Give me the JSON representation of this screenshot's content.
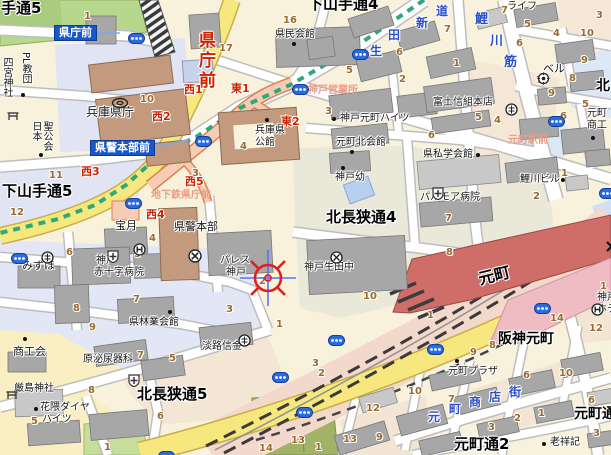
{
  "map": {
    "colors": {
      "road_yellow": "#f6e87f",
      "rail_band_pink": "#f3d9cb",
      "jr_station_red": "#cf6d68",
      "hanshin_station_pink": "#f0bcc4",
      "subway_line_green": "#2fa87c",
      "subway_corridor_salmon": "#f6cdb4",
      "station_badge_blue": "#1658cc",
      "exit_label_red": "#cc2200",
      "block_number_brown": "#9a6a2f",
      "street_name_blue": "#2b50c8",
      "area_label_pink": "#eb9c87"
    },
    "labels": [
      {
        "t": "手通5",
        "x": 1,
        "y": 1,
        "c": "d",
        "fs": 15,
        "n": "district-label"
      },
      {
        "t": "下山手通4",
        "x": 308,
        "y": -3,
        "c": "d",
        "fs": 15,
        "n": "district-label"
      },
      {
        "t": "下山手通5",
        "x": 2,
        "y": 184,
        "c": "d",
        "fs": 15,
        "n": "district-label"
      },
      {
        "t": "北長狭通4",
        "x": 326,
        "y": 210,
        "c": "d",
        "fs": 15,
        "n": "district-label"
      },
      {
        "t": "北長狭通5",
        "x": 137,
        "y": 387,
        "c": "d",
        "fs": 15,
        "n": "district-label"
      },
      {
        "t": "元町通2",
        "x": 454,
        "y": 437,
        "c": "d",
        "fs": 15,
        "n": "district-label"
      },
      {
        "t": "元町通",
        "x": 574,
        "y": 407,
        "c": "d",
        "fs": 14,
        "n": "district-label"
      },
      {
        "t": "北",
        "x": 596,
        "y": 79,
        "c": "d",
        "fs": 14,
        "n": "district-label"
      },
      {
        "t": "阪神元町",
        "x": 498,
        "y": 332,
        "c": "d",
        "fs": 14,
        "n": "hanshin-motomachi-station-label"
      },
      {
        "t": "元町",
        "x": 477,
        "y": 272,
        "c": "d",
        "fs": 16,
        "r": -14,
        "n": "jr-motomachi-station-label"
      },
      {
        "t": "県庁前",
        "x": 196,
        "y": 31,
        "c": "rv",
        "n": "subway-kenchomae-label"
      },
      {
        "t": "西1",
        "x": 184,
        "y": 84,
        "c": "r",
        "n": "exit-label"
      },
      {
        "t": "東1",
        "x": 231,
        "y": 83,
        "c": "r",
        "n": "exit-label"
      },
      {
        "t": "西2",
        "x": 152,
        "y": 111,
        "c": "r",
        "n": "exit-label"
      },
      {
        "t": "東2",
        "x": 281,
        "y": 116,
        "c": "r",
        "n": "exit-label"
      },
      {
        "t": "西3",
        "x": 81,
        "y": 166,
        "c": "r",
        "n": "exit-label"
      },
      {
        "t": "西5",
        "x": 185,
        "y": 176,
        "c": "r",
        "n": "exit-label"
      },
      {
        "t": "西4",
        "x": 146,
        "y": 209,
        "c": "r",
        "n": "exit-label"
      },
      {
        "t": "神戸営業所",
        "x": 308,
        "y": 86,
        "c": "pk",
        "n": "area-label"
      },
      {
        "t": "地下鉄県庁前",
        "x": 151,
        "y": 191,
        "c": "pk",
        "n": "area-label"
      },
      {
        "t": "元町駅前",
        "x": 508,
        "y": 136,
        "c": "pk",
        "n": "area-label"
      },
      {
        "t": "生",
        "x": 370,
        "y": 45,
        "c": "b",
        "n": "street-name-ikuta-shindo"
      },
      {
        "t": "田",
        "x": 388,
        "y": 29,
        "c": "b",
        "n": "street-name-ikuta-shindo"
      },
      {
        "t": "新",
        "x": 416,
        "y": 17,
        "c": "b",
        "n": "street-name-ikuta-shindo"
      },
      {
        "t": "道",
        "x": 436,
        "y": 5,
        "c": "b",
        "n": "street-name-ikuta-shindo"
      },
      {
        "t": "鯉",
        "x": 475,
        "y": 13,
        "c": "b",
        "fs": 13,
        "n": "street-name-koikawa-suji"
      },
      {
        "t": "川",
        "x": 490,
        "y": 35,
        "c": "b",
        "fs": 13,
        "n": "street-name-koikawa-suji"
      },
      {
        "t": "筋",
        "x": 504,
        "y": 56,
        "c": "b",
        "fs": 13,
        "n": "street-name-koikawa-suji"
      },
      {
        "t": "元",
        "x": 428,
        "y": 411,
        "c": "b",
        "n": "street-name-motomachi-shotengai"
      },
      {
        "t": "町",
        "x": 449,
        "y": 403,
        "c": "b",
        "n": "street-name-motomachi-shotengai"
      },
      {
        "t": "商",
        "x": 469,
        "y": 396,
        "c": "b",
        "n": "street-name-motomachi-shotengai"
      },
      {
        "t": "店",
        "x": 489,
        "y": 391,
        "c": "b",
        "n": "street-name-motomachi-shotengai"
      },
      {
        "t": "街",
        "x": 509,
        "y": 386,
        "c": "b",
        "n": "street-name-motomachi-shotengai"
      },
      {
        "t": "県庁前",
        "x": 54,
        "y": 25,
        "c": "bd",
        "n": "station-badge-kenchomae"
      },
      {
        "t": "県警本部前",
        "x": 90,
        "y": 140,
        "c": "bd",
        "n": "station-badge-kenkeihonbumae"
      },
      {
        "t": "兵庫県庁",
        "x": 86,
        "y": 106,
        "c": "p",
        "fs": 12,
        "n": "poi-hyogo-prefectural-office"
      },
      {
        "t": "県民会館",
        "x": 275,
        "y": 30,
        "c": "p",
        "n": "poi-kenmin-kaikan"
      },
      {
        "t": "兵庫県",
        "x": 255,
        "y": 126,
        "c": "p",
        "n": "poi-hyogo-kokan"
      },
      {
        "t": "公館",
        "x": 255,
        "y": 138,
        "c": "p",
        "n": "poi-hyogo-kokan"
      },
      {
        "t": "県警本部",
        "x": 174,
        "y": 221,
        "c": "p",
        "fs": 11,
        "n": "poi-police-hq"
      },
      {
        "t": "パレス",
        "x": 220,
        "y": 256,
        "c": "p",
        "n": "poi-palace-kobe"
      },
      {
        "t": "神戸",
        "x": 226,
        "y": 268,
        "c": "p",
        "n": "poi-palace-kobe"
      },
      {
        "t": "宝月",
        "x": 115,
        "y": 220,
        "c": "p",
        "fs": 11,
        "n": "poi-hogetsu"
      },
      {
        "t": "みずほ",
        "x": 22,
        "y": 260,
        "c": "p",
        "fs": 11,
        "n": "poi-mizuho"
      },
      {
        "t": "神戸",
        "x": 96,
        "y": 256,
        "c": "p",
        "n": "poi-red-cross-hospital"
      },
      {
        "t": "赤十字病院",
        "x": 94,
        "y": 268,
        "c": "p",
        "n": "poi-red-cross-hospital"
      },
      {
        "t": "県林業会館",
        "x": 129,
        "y": 318,
        "c": "p",
        "n": "poi-kenringyo-kaikan"
      },
      {
        "t": "商工会",
        "x": 13,
        "y": 346,
        "c": "p",
        "fs": 11,
        "n": "poi-shokokai"
      },
      {
        "t": "厳島神社",
        "x": 14,
        "y": 384,
        "c": "p",
        "n": "poi-itsukushima-shrine"
      },
      {
        "t": "花隈ダイヤ",
        "x": 40,
        "y": 403,
        "c": "p",
        "n": "poi-hanakuma-daiya-heights"
      },
      {
        "t": "ハイツ",
        "x": 42,
        "y": 415,
        "c": "p",
        "n": "poi-hanakuma-daiya-heights"
      },
      {
        "t": "原泌尿器科",
        "x": 83,
        "y": 355,
        "c": "p",
        "n": "poi-hara-urology"
      },
      {
        "t": "淡路信金",
        "x": 202,
        "y": 342,
        "c": "p",
        "n": "poi-awaji-shinkin"
      },
      {
        "t": "神戸元町ハイツ",
        "x": 340,
        "y": 114,
        "c": "p",
        "n": "poi-kobe-motomachi-heights"
      },
      {
        "t": "元町北会館",
        "x": 336,
        "y": 138,
        "c": "p",
        "n": "poi-motomachi-kita-kaikan"
      },
      {
        "t": "神戸幼",
        "x": 335,
        "y": 173,
        "c": "p",
        "n": "poi-kobe-kindergarten"
      },
      {
        "t": "県私学会館",
        "x": 423,
        "y": 150,
        "c": "p",
        "n": "poi-shigaku-kaikan"
      },
      {
        "t": "パルモア病院",
        "x": 420,
        "y": 193,
        "c": "p",
        "n": "poi-palmore-hospital"
      },
      {
        "t": "富士信組本店",
        "x": 433,
        "y": 98,
        "c": "p",
        "n": "poi-fuji-shinkumi"
      },
      {
        "t": "鯉川ビル",
        "x": 520,
        "y": 175,
        "c": "p",
        "n": "poi-koikawa-building"
      },
      {
        "t": "ベル",
        "x": 543,
        "y": 63,
        "c": "p",
        "fs": 11,
        "n": "poi-bell"
      },
      {
        "t": "元町",
        "x": 511,
        "y": -9,
        "c": "p",
        "n": "poi-motomachi-life"
      },
      {
        "t": "ライフ",
        "x": 507,
        "y": 2,
        "c": "p",
        "n": "poi-motomachi-life"
      },
      {
        "t": "神戸生田中",
        "x": 304,
        "y": 263,
        "c": "p",
        "n": "poi-kobe-ikuta-junior-high"
      },
      {
        "t": "元町プラザ",
        "x": 448,
        "y": 367,
        "c": "p",
        "n": "poi-motomachi-plaza"
      },
      {
        "t": "老祥記",
        "x": 550,
        "y": 438,
        "c": "p",
        "n": "poi-roshoki"
      },
      {
        "t": "元町",
        "x": 587,
        "y": 109,
        "c": "p",
        "n": "poi-motomachi-shoko"
      },
      {
        "t": "商工",
        "x": 587,
        "y": 121,
        "c": "p",
        "n": "poi-motomachi-shoko"
      },
      {
        "t": "神戸",
        "x": 597,
        "y": 293,
        "c": "p",
        "n": "poi-kobe-hotel"
      },
      {
        "t": "ホテ",
        "x": 597,
        "y": 305,
        "c": "p",
        "n": "poi-kobe-hotel"
      },
      {
        "t": "四宮神社",
        "x": 1,
        "y": 57,
        "c": "p",
        "v": 1,
        "n": "poi-shinomiya-shrine"
      },
      {
        "t": "PL教団",
        "x": 20,
        "y": 52,
        "c": "p",
        "v": 1,
        "n": "poi-pl-kyodan"
      },
      {
        "t": "日本",
        "x": 30,
        "y": 121,
        "c": "p",
        "v": 1,
        "n": "poi-nihon-seikokai"
      },
      {
        "t": "聖公会",
        "x": 41,
        "y": 121,
        "c": "p",
        "v": 1,
        "n": "poi-nihon-seikokai"
      },
      {
        "t": "1",
        "x": 84,
        "y": 12,
        "c": "n"
      },
      {
        "t": "17",
        "x": 219,
        "y": 44,
        "c": "n"
      },
      {
        "t": "16",
        "x": 283,
        "y": 16,
        "c": "n"
      },
      {
        "t": "10",
        "x": 140,
        "y": 95,
        "c": "n"
      },
      {
        "t": "4",
        "x": 240,
        "y": 142,
        "c": "n"
      },
      {
        "t": "3",
        "x": 192,
        "y": 169,
        "c": "n"
      },
      {
        "t": "11",
        "x": 49,
        "y": 171,
        "c": "n"
      },
      {
        "t": "12",
        "x": 10,
        "y": 208,
        "c": "n"
      },
      {
        "t": "7",
        "x": 501,
        "y": 6,
        "c": "n"
      },
      {
        "t": "5",
        "x": 524,
        "y": 20,
        "c": "n"
      },
      {
        "t": "4",
        "x": 553,
        "y": 29,
        "c": "n"
      },
      {
        "t": "10",
        "x": 580,
        "y": 29,
        "c": "n"
      },
      {
        "t": "3",
        "x": 596,
        "y": 11,
        "c": "n"
      },
      {
        "t": "7",
        "x": 444,
        "y": 25,
        "c": "n"
      },
      {
        "t": "6",
        "x": 396,
        "y": 48,
        "c": "n"
      },
      {
        "t": "1",
        "x": 453,
        "y": 59,
        "c": "n"
      },
      {
        "t": "2",
        "x": 399,
        "y": 75,
        "c": "n"
      },
      {
        "t": "5",
        "x": 346,
        "y": 66,
        "c": "n"
      },
      {
        "t": "3",
        "x": 325,
        "y": 107,
        "c": "n"
      },
      {
        "t": "6",
        "x": 516,
        "y": 39,
        "c": "n"
      },
      {
        "t": "9",
        "x": 581,
        "y": 56,
        "c": "n"
      },
      {
        "t": "8",
        "x": 569,
        "y": 74,
        "c": "n"
      },
      {
        "t": "7",
        "x": 536,
        "y": 76,
        "c": "n"
      },
      {
        "t": "9",
        "x": 548,
        "y": 89,
        "c": "n"
      },
      {
        "t": "6",
        "x": 560,
        "y": 112,
        "c": "n"
      },
      {
        "t": "5",
        "x": 475,
        "y": 113,
        "c": "n"
      },
      {
        "t": "4",
        "x": 494,
        "y": 116,
        "c": "n"
      },
      {
        "t": "6",
        "x": 428,
        "y": 131,
        "c": "n"
      },
      {
        "t": "1",
        "x": 561,
        "y": 169,
        "c": "n"
      },
      {
        "t": "2",
        "x": 533,
        "y": 192,
        "c": "n"
      },
      {
        "t": "7",
        "x": 445,
        "y": 214,
        "c": "n"
      },
      {
        "t": "5",
        "x": 582,
        "y": 100,
        "c": "n"
      },
      {
        "t": "6",
        "x": 66,
        "y": 248,
        "c": "n"
      },
      {
        "t": "5",
        "x": 134,
        "y": 250,
        "c": "n"
      },
      {
        "t": "4",
        "x": 149,
        "y": 234,
        "c": "n"
      },
      {
        "t": "2",
        "x": 259,
        "y": 277,
        "c": "n"
      },
      {
        "t": "3",
        "x": 226,
        "y": 305,
        "c": "n"
      },
      {
        "t": "1",
        "x": 276,
        "y": 320,
        "c": "n"
      },
      {
        "t": "8",
        "x": 73,
        "y": 304,
        "c": "n"
      },
      {
        "t": "9",
        "x": 89,
        "y": 323,
        "c": "n"
      },
      {
        "t": "7",
        "x": 133,
        "y": 295,
        "c": "n"
      },
      {
        "t": "4",
        "x": 241,
        "y": 337,
        "c": "n"
      },
      {
        "t": "7",
        "x": 137,
        "y": 351,
        "c": "n"
      },
      {
        "t": "5",
        "x": 169,
        "y": 354,
        "c": "n"
      },
      {
        "t": "8",
        "x": 88,
        "y": 386,
        "c": "n"
      },
      {
        "t": "5",
        "x": 31,
        "y": 417,
        "c": "n"
      },
      {
        "t": "6",
        "x": 157,
        "y": 412,
        "c": "n"
      },
      {
        "t": "1",
        "x": 104,
        "y": 443,
        "c": "n"
      },
      {
        "t": "1",
        "x": 315,
        "y": 443,
        "c": "n"
      },
      {
        "t": "13",
        "x": 291,
        "y": 436,
        "c": "n"
      },
      {
        "t": "14",
        "x": 259,
        "y": 444,
        "c": "n"
      },
      {
        "t": "13",
        "x": 343,
        "y": 435,
        "c": "n"
      },
      {
        "t": "3",
        "x": 312,
        "y": 359,
        "c": "n"
      },
      {
        "t": "2",
        "x": 318,
        "y": 369,
        "c": "n"
      },
      {
        "t": "8",
        "x": 446,
        "y": 248,
        "c": "n"
      },
      {
        "t": "10",
        "x": 363,
        "y": 292,
        "c": "n"
      },
      {
        "t": "1",
        "x": 427,
        "y": 311,
        "c": "n"
      },
      {
        "t": "14",
        "x": 550,
        "y": 314,
        "c": "n"
      },
      {
        "t": "12",
        "x": 589,
        "y": 324,
        "c": "n"
      },
      {
        "t": "8",
        "x": 489,
        "y": 341,
        "c": "n"
      },
      {
        "t": "9",
        "x": 470,
        "y": 348,
        "c": "n"
      },
      {
        "t": "6",
        "x": 523,
        "y": 371,
        "c": "n"
      },
      {
        "t": "10",
        "x": 559,
        "y": 369,
        "c": "n"
      },
      {
        "t": "10",
        "x": 408,
        "y": 387,
        "c": "n"
      },
      {
        "t": "7",
        "x": 448,
        "y": 395,
        "c": "n"
      },
      {
        "t": "12",
        "x": 366,
        "y": 404,
        "c": "n"
      },
      {
        "t": "9",
        "x": 376,
        "y": 433,
        "c": "n"
      },
      {
        "t": "2",
        "x": 514,
        "y": 414,
        "c": "n"
      },
      {
        "t": "3",
        "x": 488,
        "y": 423,
        "c": "n"
      },
      {
        "t": "1",
        "x": 538,
        "y": 409,
        "c": "n"
      },
      {
        "t": "6",
        "x": 588,
        "y": 396,
        "c": "n"
      },
      {
        "t": "3",
        "x": 593,
        "y": 429,
        "c": "n"
      },
      {
        "t": "1",
        "x": 600,
        "y": 282,
        "c": "n"
      }
    ],
    "dots": [
      [
        294,
        44
      ],
      [
        267,
        120
      ],
      [
        41,
        155
      ],
      [
        23,
        95
      ],
      [
        334,
        119
      ],
      [
        352,
        152
      ],
      [
        343,
        168
      ],
      [
        478,
        155
      ],
      [
        563,
        180
      ],
      [
        170,
        312
      ],
      [
        25,
        339
      ],
      [
        36,
        409
      ],
      [
        457,
        361
      ],
      [
        544,
        444
      ],
      [
        593,
        138
      ]
    ],
    "icons": [
      {
        "type": "tram-stop",
        "x": 128,
        "y": 33
      },
      {
        "type": "tram-stop",
        "x": 292,
        "y": 84
      },
      {
        "type": "tram-stop",
        "x": 352,
        "y": 49
      },
      {
        "type": "tram-stop",
        "x": 195,
        "y": 136
      },
      {
        "type": "tram-stop",
        "x": 125,
        "y": 198
      },
      {
        "type": "tram-stop",
        "x": 11,
        "y": 253
      },
      {
        "type": "tram-stop",
        "x": 548,
        "y": 116
      },
      {
        "type": "tram-stop",
        "x": 599,
        "y": 188
      },
      {
        "type": "tram-stop",
        "x": 328,
        "y": 335
      },
      {
        "type": "tram-stop",
        "x": 272,
        "y": 372
      },
      {
        "type": "tram-stop",
        "x": 296,
        "y": 407
      },
      {
        "type": "tram-stop",
        "x": 427,
        "y": 344
      },
      {
        "type": "tram-stop",
        "x": 534,
        "y": 303
      },
      {
        "type": "tram-stop",
        "x": 158,
        "y": 451
      },
      {
        "type": "bank",
        "x": 41,
        "y": 251
      },
      {
        "type": "bank",
        "x": 505,
        "y": 103
      },
      {
        "type": "bank",
        "x": 238,
        "y": 334
      },
      {
        "type": "bell",
        "x": 537,
        "y": 72
      },
      {
        "type": "hospital",
        "x": 107,
        "y": 250
      },
      {
        "type": "hospital",
        "x": 432,
        "y": 187
      },
      {
        "type": "hospital",
        "x": 128,
        "y": 374
      },
      {
        "type": "hotel",
        "x": 133,
        "y": 243
      },
      {
        "type": "hotel",
        "x": 591,
        "y": 303
      },
      {
        "type": "school",
        "x": 330,
        "y": 251
      },
      {
        "type": "police",
        "x": 188,
        "y": 249
      },
      {
        "type": "govt",
        "x": 111,
        "y": 97
      },
      {
        "type": "torii",
        "x": 7,
        "y": 110
      },
      {
        "type": "torii",
        "x": 6,
        "y": 389
      },
      {
        "type": "crossing",
        "x": 606,
        "y": 241
      },
      {
        "type": "crosshair",
        "x": 238,
        "y": 248
      }
    ]
  }
}
